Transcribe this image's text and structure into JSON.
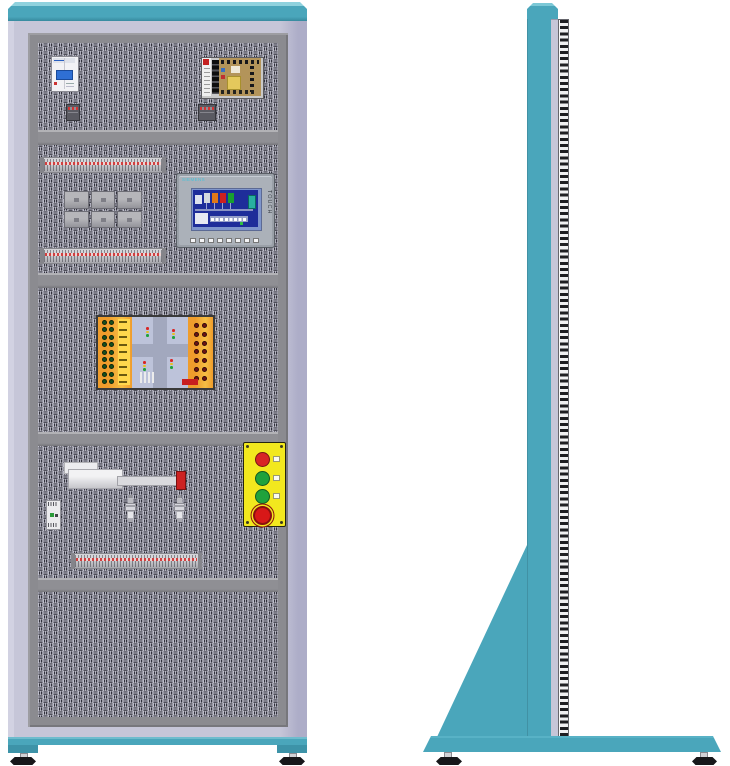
{
  "scene": {
    "background": "#ffffff",
    "description": "Industrial electrical training cabinet shown in front and side orthographic views"
  },
  "palette": {
    "teal": "#4aa6bb",
    "teal_dark": "#37899e",
    "lavender": "#c6c6d8",
    "frame_gray": "#8b8b90",
    "weave_bg": "#c9c9d6",
    "weave_bar": "#30303a",
    "signal_red": "#d82525",
    "signal_green": "#1fa23c",
    "panel_yellow": "#f2e81e",
    "hmi_screen_blue": "#1e2d9a"
  },
  "front_view": {
    "label": "front view",
    "circuit_breaker": {
      "label": "2-pole circuit breaker"
    },
    "power_supply": {
      "label": "open-frame switching power supply"
    },
    "terminal_rails": {
      "count": 3
    },
    "relay_group": {
      "blocks": 6
    },
    "hmi": {
      "brand": "SIEMENS",
      "vertical_label": "TOUCH",
      "function_keys": 8
    },
    "traffic_board": {
      "label": "traffic intersection trainer board",
      "left_sockets": {
        "rows": 9,
        "cols": 2,
        "color": "#17501d"
      },
      "right_sockets": {
        "rows": 7,
        "cols": 2,
        "color": "#6d1414"
      },
      "label_rows": 9,
      "traffic_light_colors": [
        "#d82525",
        "#e8c020",
        "#1fa23c"
      ]
    },
    "linear_actuator": {
      "label": "linear actuator with rod and red end stopper"
    },
    "sensors": {
      "count": 2
    },
    "pushbutton_station": {
      "buttons": [
        {
          "type": "pushbutton",
          "color": "#d82525",
          "label_tag": true
        },
        {
          "type": "pushbutton",
          "color": "#1fa23c",
          "label_tag": true
        },
        {
          "type": "pushbutton",
          "color": "#1fa23c",
          "label_tag": true
        },
        {
          "type": "emergency-stop",
          "color": "#d81818",
          "label_tag": false
        }
      ]
    }
  },
  "side_view": {
    "label": "side view"
  }
}
